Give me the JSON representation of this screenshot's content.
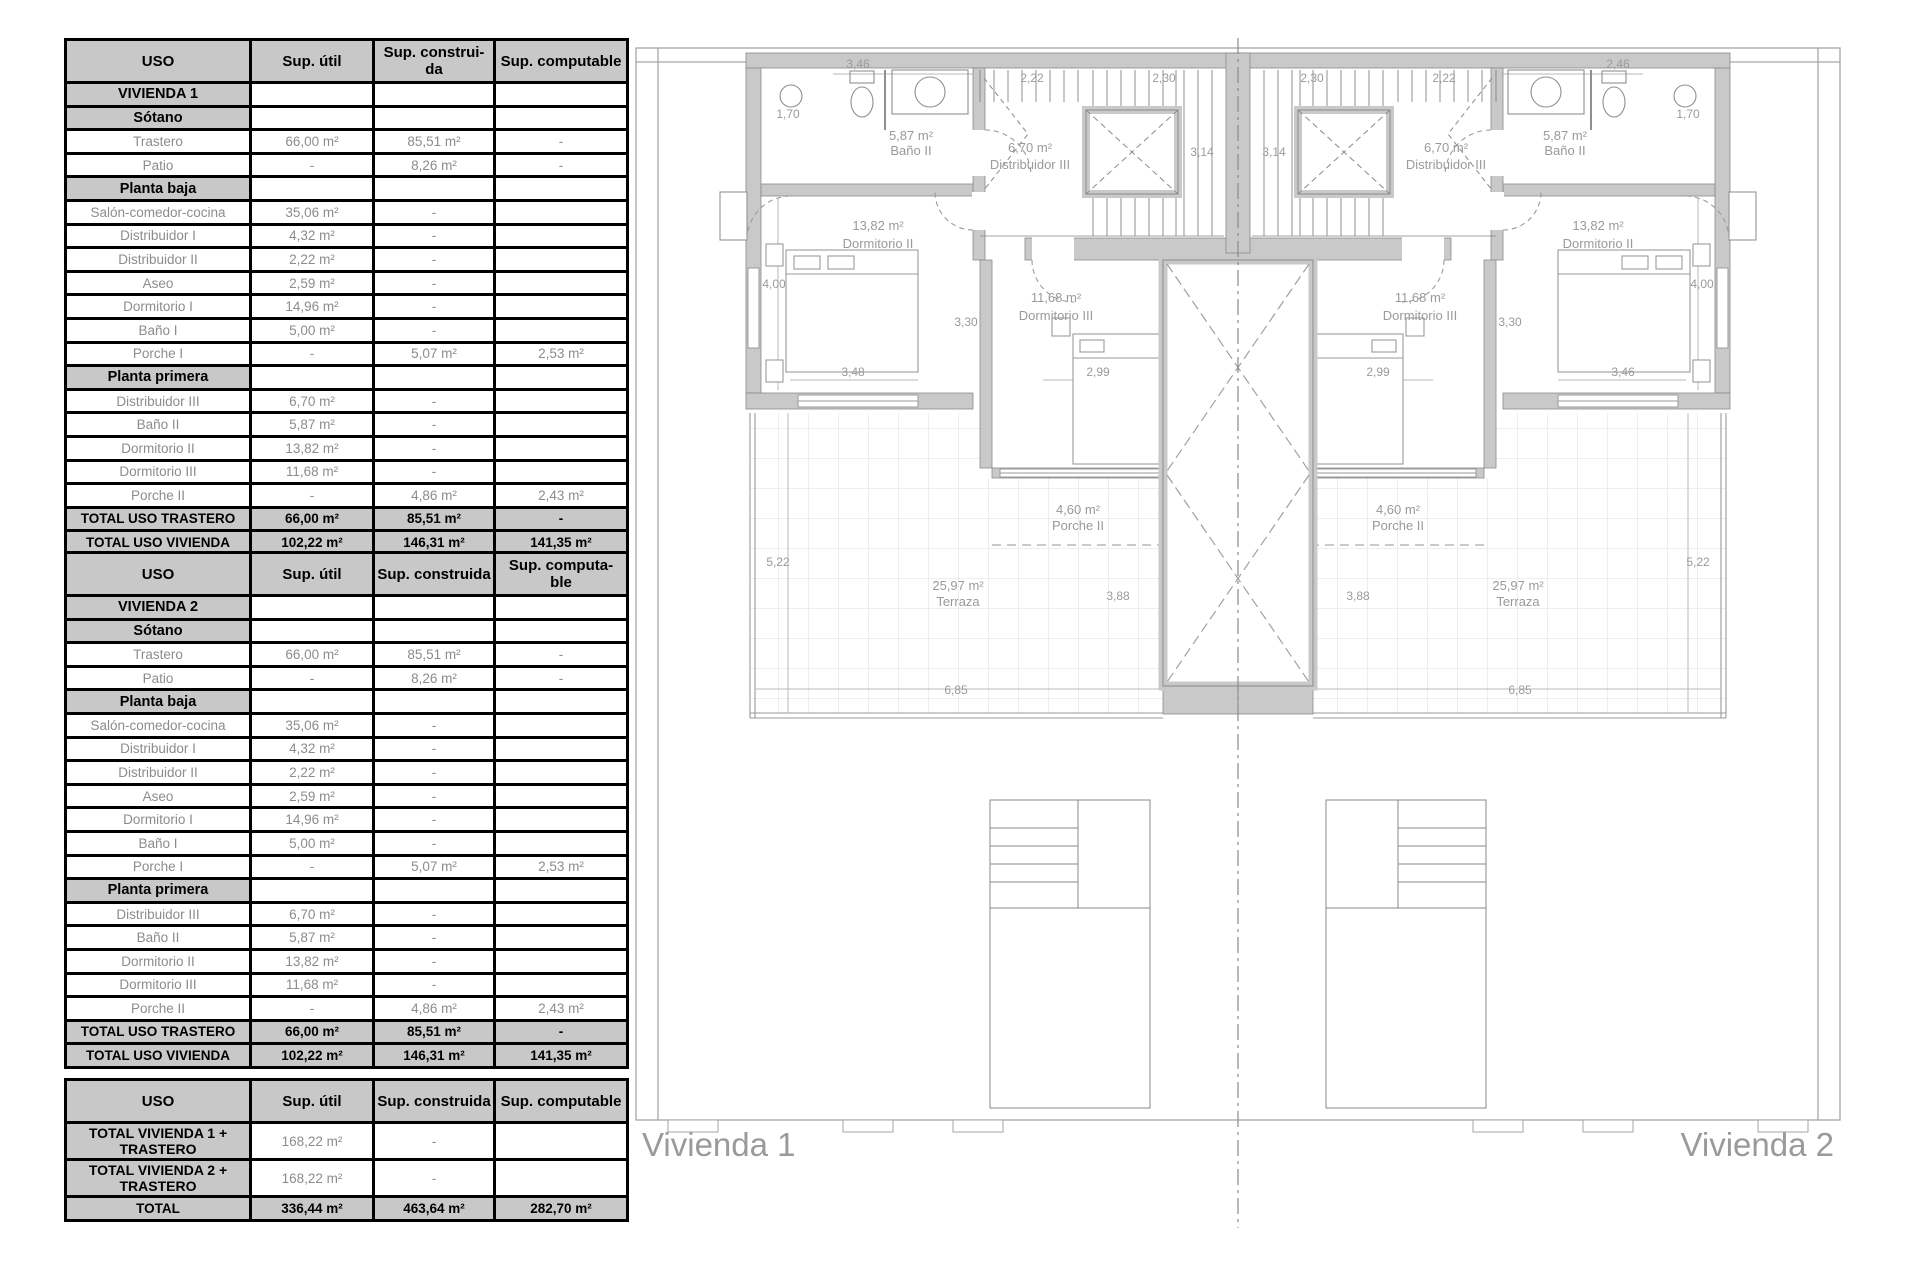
{
  "tables": {
    "t1": {
      "head": [
        "USO",
        "Sup. útil",
        "Sup. construi-\nda",
        "Sup. computable"
      ],
      "rows": [
        {
          "t": "s",
          "c": [
            "VIVIENDA 1",
            "",
            "",
            ""
          ]
        },
        {
          "t": "s",
          "c": [
            "Sótano",
            "",
            "",
            ""
          ]
        },
        {
          "t": "d",
          "c": [
            "Trastero",
            "66,00 m²",
            "85,51 m²",
            "-"
          ]
        },
        {
          "t": "d",
          "c": [
            "Patio",
            "-",
            "8,26 m²",
            "-"
          ]
        },
        {
          "t": "s",
          "c": [
            "Planta baja",
            "",
            "",
            ""
          ]
        },
        {
          "t": "d",
          "c": [
            "Salón-comedor-cocina",
            "35,06 m²",
            "-",
            ""
          ]
        },
        {
          "t": "d",
          "c": [
            "Distribuidor I",
            "4,32 m²",
            "-",
            ""
          ]
        },
        {
          "t": "d",
          "c": [
            "Distribuidor II",
            "2,22 m²",
            "-",
            ""
          ]
        },
        {
          "t": "d",
          "c": [
            "Aseo",
            "2,59 m²",
            "-",
            ""
          ]
        },
        {
          "t": "d",
          "c": [
            "Dormitorio I",
            "14,96 m²",
            "-",
            ""
          ]
        },
        {
          "t": "d",
          "c": [
            "Baño I",
            "5,00 m²",
            "-",
            ""
          ]
        },
        {
          "t": "d",
          "c": [
            "Porche I",
            "-",
            "5,07 m²",
            "2,53 m²"
          ]
        },
        {
          "t": "s",
          "c": [
            "Planta primera",
            "",
            "",
            ""
          ]
        },
        {
          "t": "d",
          "c": [
            "Distribuidor III",
            "6,70 m²",
            "-",
            ""
          ]
        },
        {
          "t": "d",
          "c": [
            "Baño II",
            "5,87 m²",
            "-",
            ""
          ]
        },
        {
          "t": "d",
          "c": [
            "Dormitorio II",
            "13,82 m²",
            "-",
            ""
          ]
        },
        {
          "t": "d",
          "c": [
            "Dormitorio III",
            "11,68 m²",
            "-",
            ""
          ]
        },
        {
          "t": "d",
          "c": [
            "Porche II",
            "-",
            "4,86 m²",
            "2,43 m²"
          ]
        },
        {
          "t": "T",
          "c": [
            "TOTAL USO TRASTERO",
            "66,00 m²",
            "85,51 m²",
            "-"
          ]
        },
        {
          "t": "T",
          "c": [
            "TOTAL USO VIVIENDA",
            "102,22 m²",
            "146,31 m²",
            "141,35 m²"
          ]
        }
      ]
    },
    "t2": {
      "head": [
        "USO",
        "Sup. útil",
        "Sup. construida",
        "Sup. computa-\nble"
      ],
      "rows": [
        {
          "t": "s",
          "c": [
            "VIVIENDA 2",
            "",
            "",
            ""
          ]
        },
        {
          "t": "s",
          "c": [
            "Sótano",
            "",
            "",
            ""
          ]
        },
        {
          "t": "d",
          "c": [
            "Trastero",
            "66,00 m²",
            "85,51 m²",
            "-"
          ]
        },
        {
          "t": "d",
          "c": [
            "Patio",
            "-",
            "8,26 m²",
            "-"
          ]
        },
        {
          "t": "s",
          "c": [
            "Planta baja",
            "",
            "",
            ""
          ]
        },
        {
          "t": "d",
          "c": [
            "Salón-comedor-cocina",
            "35,06 m²",
            "-",
            ""
          ]
        },
        {
          "t": "d",
          "c": [
            "Distribuidor I",
            "4,32 m²",
            "-",
            ""
          ]
        },
        {
          "t": "d",
          "c": [
            "Distribuidor II",
            "2,22 m²",
            "-",
            ""
          ]
        },
        {
          "t": "d",
          "c": [
            "Aseo",
            "2,59 m²",
            "-",
            ""
          ]
        },
        {
          "t": "d",
          "c": [
            "Dormitorio I",
            "14,96 m²",
            "-",
            ""
          ]
        },
        {
          "t": "d",
          "c": [
            "Baño I",
            "5,00 m²",
            "-",
            ""
          ]
        },
        {
          "t": "d",
          "c": [
            "Porche I",
            "-",
            "5,07 m²",
            "2,53 m²"
          ]
        },
        {
          "t": "s",
          "c": [
            "Planta primera",
            "",
            "",
            ""
          ]
        },
        {
          "t": "d",
          "c": [
            "Distribuidor III",
            "6,70 m²",
            "-",
            ""
          ]
        },
        {
          "t": "d",
          "c": [
            "Baño II",
            "5,87 m²",
            "-",
            ""
          ]
        },
        {
          "t": "d",
          "c": [
            "Dormitorio II",
            "13,82 m²",
            "-",
            ""
          ]
        },
        {
          "t": "d",
          "c": [
            "Dormitorio III",
            "11,68 m²",
            "-",
            ""
          ]
        },
        {
          "t": "d",
          "c": [
            "Porche II",
            "-",
            "4,86 m²",
            "2,43 m²"
          ]
        },
        {
          "t": "T",
          "c": [
            "TOTAL USO TRASTERO",
            "66,00 m²",
            "85,51 m²",
            "-"
          ]
        },
        {
          "t": "T",
          "c": [
            "TOTAL USO VIVIENDA",
            "102,22 m²",
            "146,31 m²",
            "141,35 m²"
          ]
        }
      ]
    },
    "t3": {
      "head": [
        "USO",
        "Sup. útil",
        "Sup. construida",
        "Sup. computable"
      ],
      "rows": [
        {
          "t": "g",
          "c": [
            "TOTAL VIVIENDA 1 + TRASTERO",
            "168,22 m²",
            "-",
            ""
          ]
        },
        {
          "t": "g",
          "c": [
            "TOTAL VIVIENDA 2 + TRASTERO",
            "168,22 m²",
            "-",
            ""
          ]
        },
        {
          "t": "T",
          "c": [
            "TOTAL",
            "336,44 m²",
            "463,64  m²",
            "282,70  m²"
          ]
        }
      ]
    }
  },
  "plan": {
    "label_left": "Vivienda 1",
    "label_right": "Vivienda 2",
    "rooms": {
      "bano": {
        "area": "5,87 m²",
        "name": "Baño II"
      },
      "distribuidor": {
        "area": "6,70 m²",
        "name": "Distribuidor III"
      },
      "dorm2": {
        "area": "13,82 m²",
        "name": "Dormitorio II"
      },
      "dorm3": {
        "area": "11,68 m²",
        "name": "Dormitorio III"
      },
      "porche": {
        "area": "4,60 m²",
        "name": "Porche II"
      },
      "terraza": {
        "area": "25,97 m²",
        "name": "Terraza"
      }
    },
    "dims": {
      "d222": "2,22",
      "d230": "2,30",
      "d346": "3,46",
      "d246": "2,46",
      "d170": "1,70",
      "d314": "3,14",
      "d400": "4,00",
      "d348": "3,48",
      "d299": "2,99",
      "d330": "3,30",
      "d522": "5,22",
      "d388": "3,88",
      "d685": "6,85"
    },
    "colors": {
      "wall": "#c9c9c9",
      "line": "#8a8a8a",
      "tile": "#dcdcdc",
      "text": "#9a9a9a"
    }
  }
}
